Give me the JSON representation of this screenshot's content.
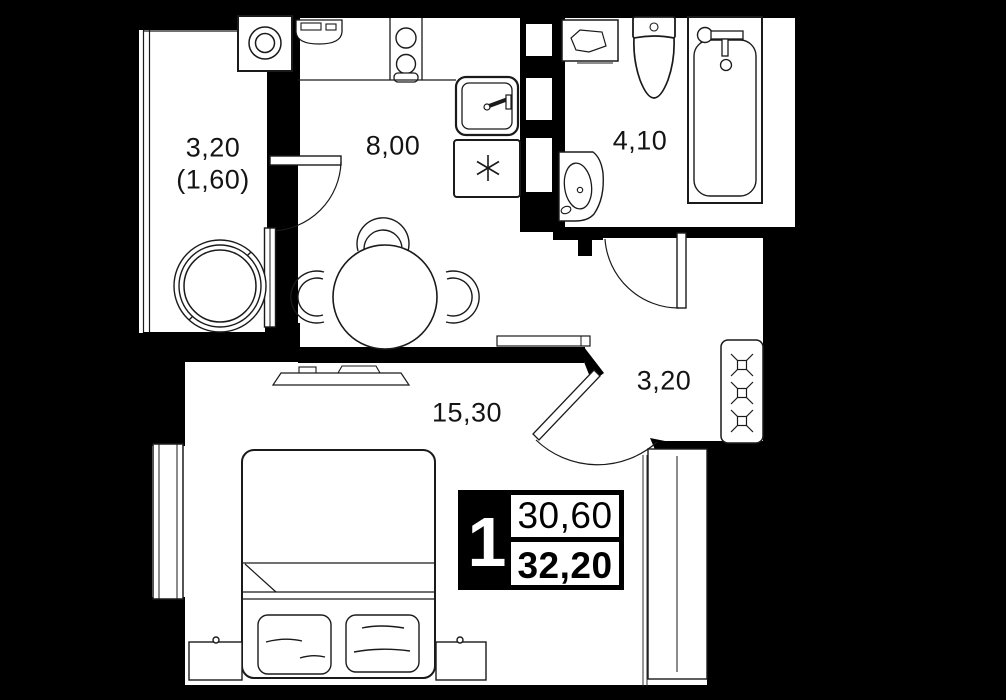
{
  "plan_type": "apartment-floor-plan",
  "colors": {
    "background": "#000000",
    "walls": "#000000",
    "floor": "#ffffff",
    "line": "#1a1a1a"
  },
  "rooms": {
    "loggia": {
      "area": "3,20",
      "reduced_area": "(1,60)"
    },
    "kitchen": {
      "area": "8,00"
    },
    "bathroom": {
      "area": "4,10"
    },
    "hallway": {
      "area": "3,20"
    },
    "living_room": {
      "area": "15,30"
    }
  },
  "badge": {
    "room_count": "1",
    "living_area": "30,60",
    "total_area": "32,20"
  },
  "furniture_icons": [
    "washing-machine-icon",
    "armchair-icon",
    "cooktop-icon",
    "oven-icon",
    "kitchen-sink-icon",
    "refrigerator-asterisk-icon",
    "dining-table-icon",
    "chair-icon",
    "tv-icon",
    "bed-icon",
    "pillow-icon",
    "nightstand-icon",
    "window-icon",
    "door-arc-icon",
    "wardrobe-hanger-icon",
    "built-in-closet-icon",
    "toilet-icon",
    "bathtub-icon",
    "washbasin-icon",
    "shelf-icon"
  ]
}
